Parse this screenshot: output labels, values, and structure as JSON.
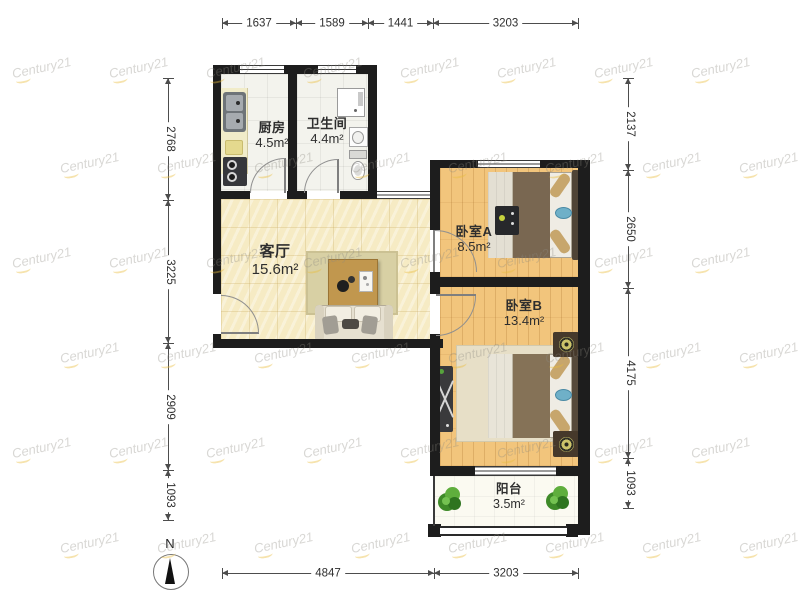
{
  "rooms": [
    {
      "name": "厨房",
      "area": "4.5m²"
    },
    {
      "name": "卫生间",
      "area": "4.4m²"
    },
    {
      "name": "客厅",
      "area": "15.6m²"
    },
    {
      "name": "卧室A",
      "area": "8.5m²"
    },
    {
      "name": "卧室B",
      "area": "13.4m²"
    },
    {
      "name": "阳台",
      "area": "3.5m²"
    }
  ],
  "dimensions": {
    "top": [
      "1637",
      "1589",
      "1441",
      "3203"
    ],
    "bottom": [
      "4847",
      "3203"
    ],
    "left": [
      "2768",
      "3225",
      "2909",
      "1093"
    ],
    "right": [
      "2137",
      "2650",
      "4175",
      "1093"
    ]
  },
  "compass": {
    "label": "N"
  },
  "watermark": {
    "text": "Century21"
  },
  "colors": {
    "wall": "#1d1d1d",
    "living_floor": "#f6ebc4",
    "bedroom_floor": "#f2c57c",
    "tile_floor": "#f3f3ed",
    "watermark_accent": "#e9bc3c"
  }
}
